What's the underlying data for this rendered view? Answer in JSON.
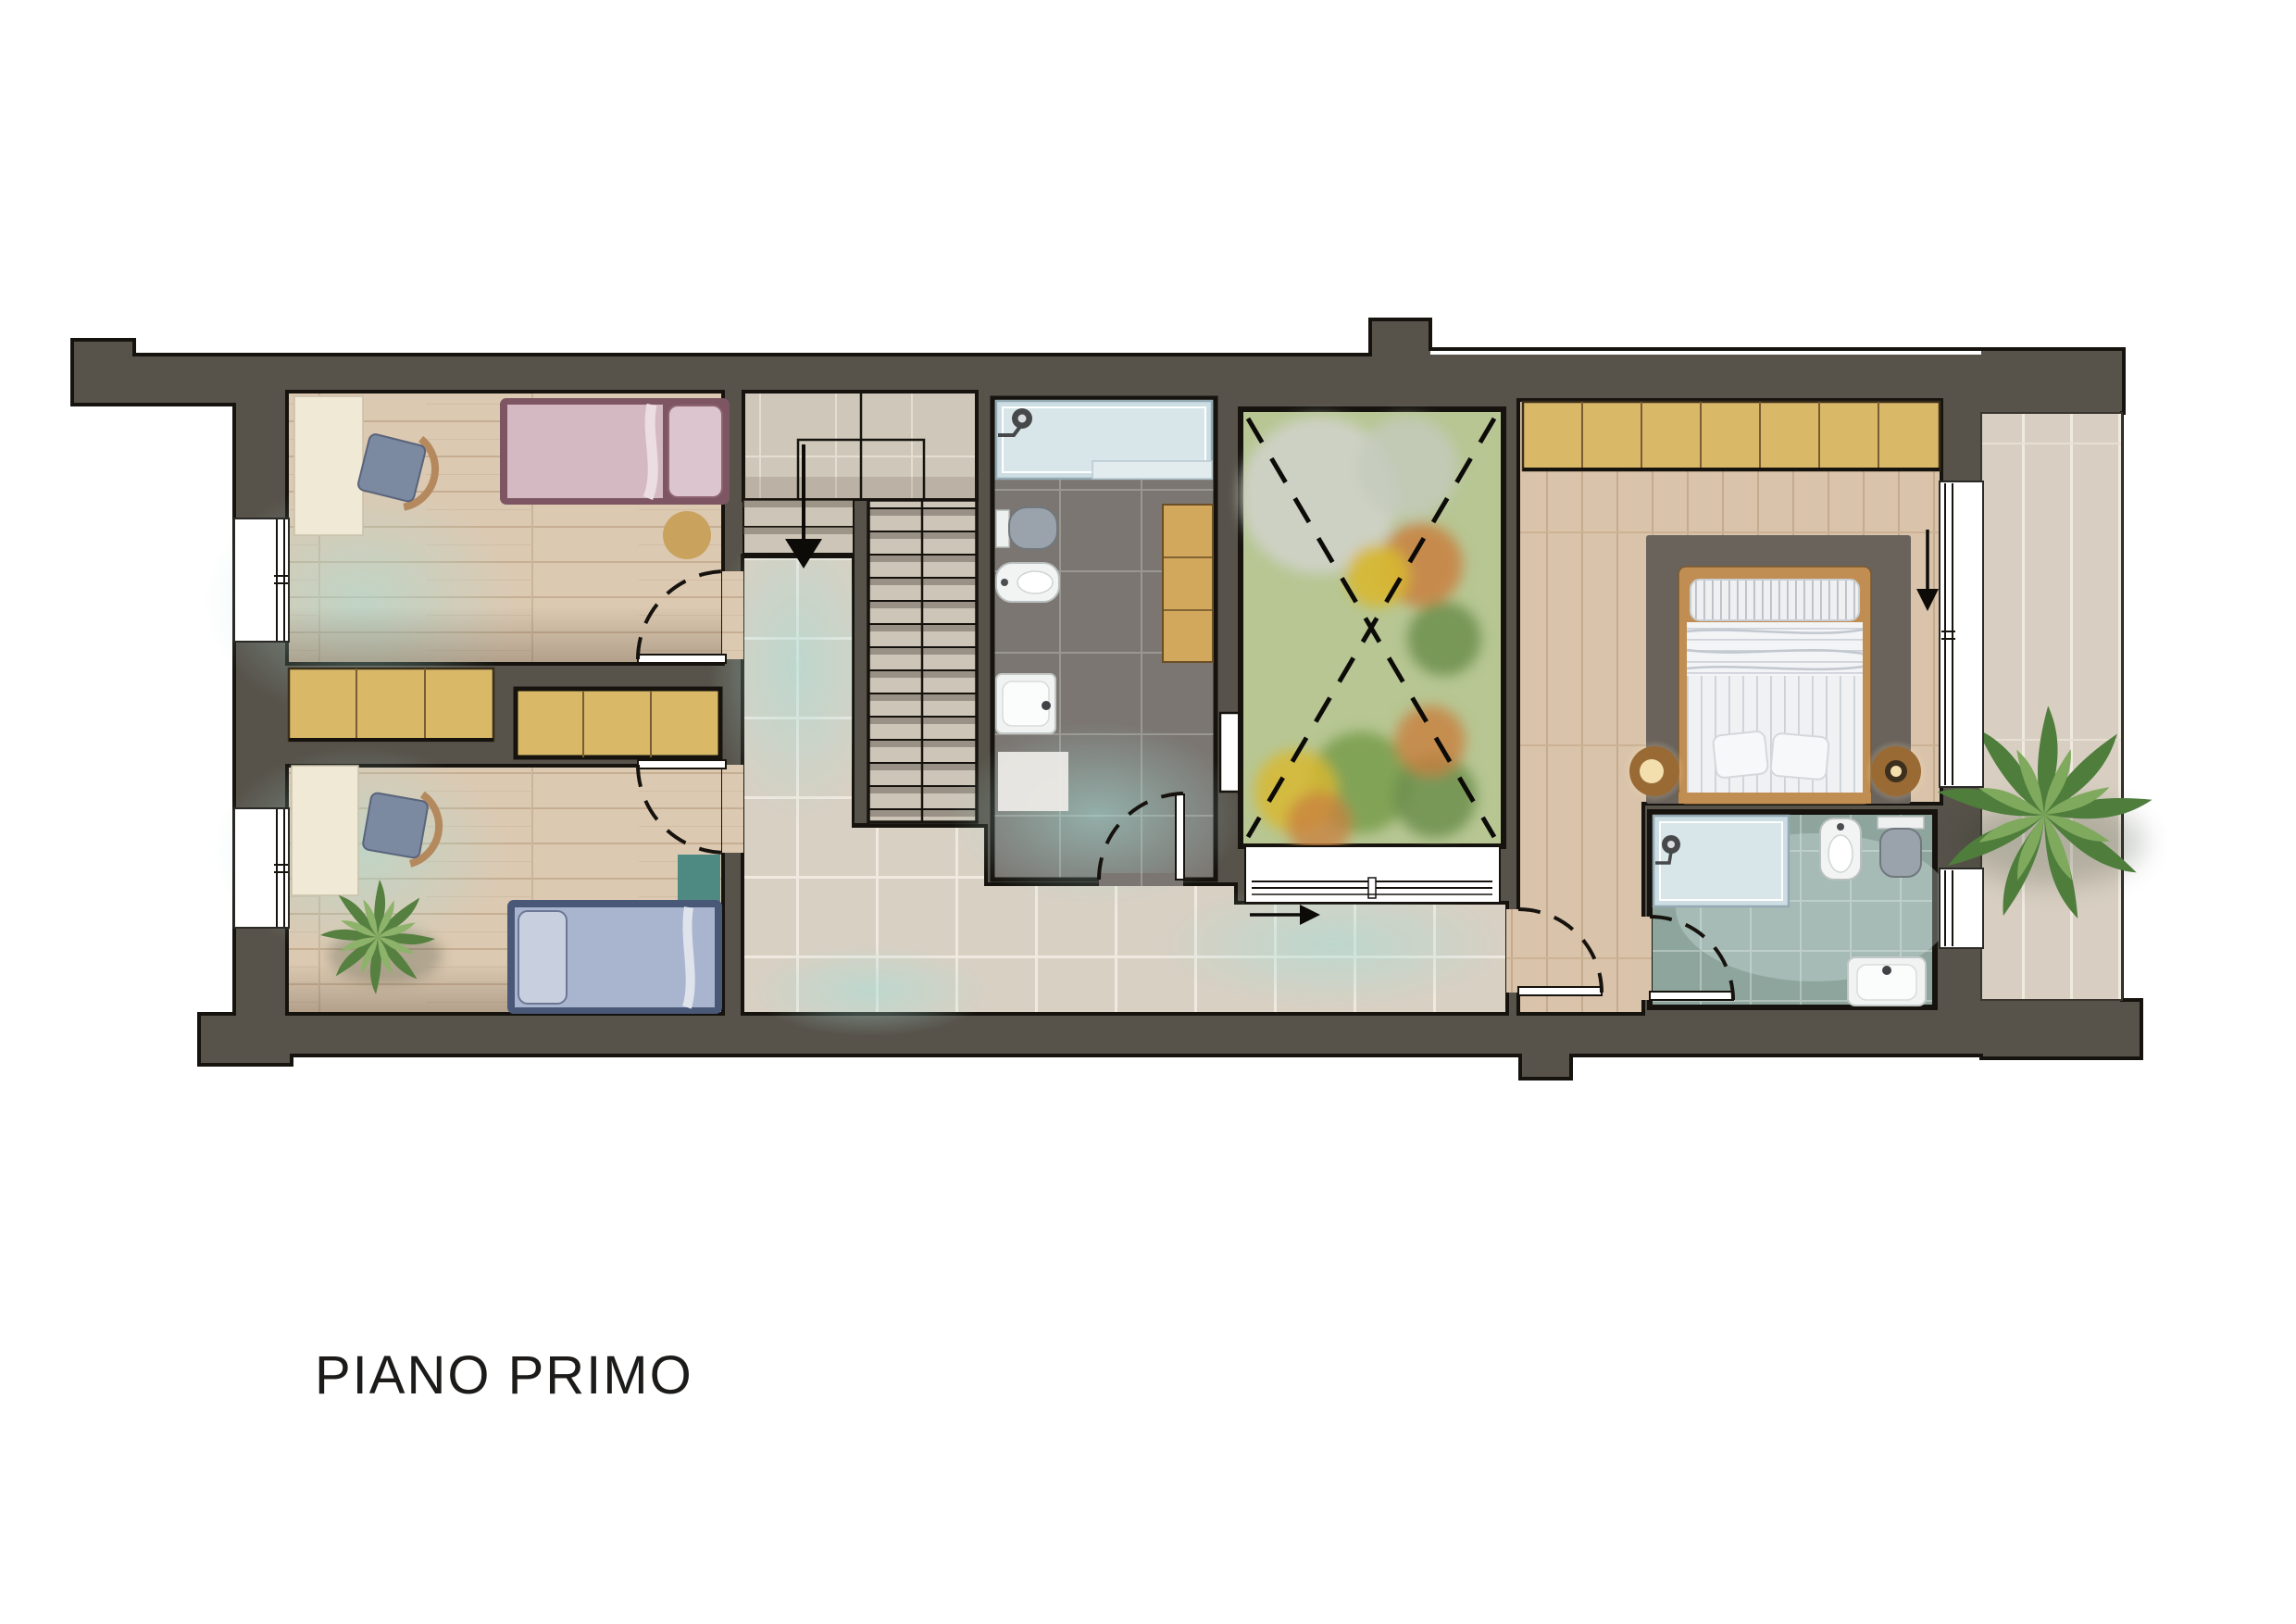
{
  "floor_plan": {
    "title": "PIANO PRIMO",
    "colors": {
      "wall": "#57524a",
      "outline": "#16130e",
      "bedroom_floor": "#dcc9b2",
      "master_floor": "#d9c3aa",
      "hallway_tile": "#d8d0c3",
      "stair_tile": "#cfc7ba",
      "bath_floor": "#7b7672",
      "ensuite_floor": "#8ea59e",
      "courtyard_green": "#b7c693",
      "wardrobe": "#d9b968",
      "desk": "#f0e9d6",
      "bed_pink_frame": "#7e5663",
      "bed_pink": "#d4b9c3",
      "bed_blue_frame": "#4a5878",
      "bed_blue": "#a9b4cf",
      "rug": "#6a635c",
      "teal_accent": "#4e8a82",
      "terrace_tile": "#d8cfc2",
      "bed_wood": "#c08d52"
    },
    "annotations": {
      "stairs_direction_icon": "down-arrow",
      "hallway_direction_icon": "right-arrow",
      "master_window_direction_icon": "down-arrow",
      "courtyard_void_icon": "dashed-x"
    }
  }
}
